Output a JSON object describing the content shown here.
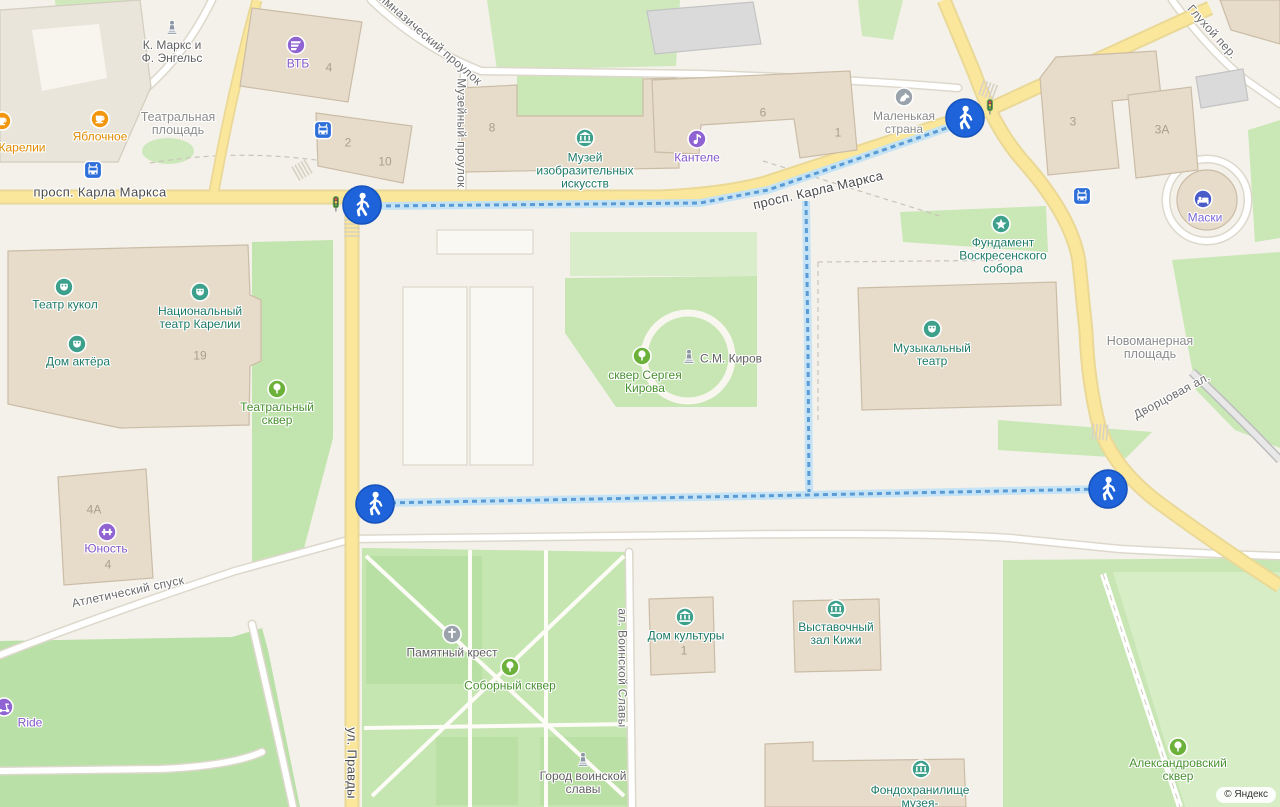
{
  "attribution": "© Яндекс",
  "palette": {
    "marker_blue": "#1e63d9",
    "route_blue": "#5a9bd5",
    "road_yellow": "#fbe79b",
    "park_green": "#c8e6b3",
    "building_tan": "#e7dbca",
    "transport_blue": "#2e6fd9"
  },
  "streets": [
    {
      "id": "prosp-karla-marksa-w",
      "label": "просп. Карла Маркса",
      "x": 100,
      "y": 192,
      "rotate": 0,
      "size": 13,
      "color": "#4c4c4c"
    },
    {
      "id": "prosp-karla-marksa-e",
      "label": "просп. Карла Маркса",
      "x": 818,
      "y": 190,
      "rotate": -13,
      "size": 13,
      "color": "#4c4c4c"
    },
    {
      "id": "ul-pravdy",
      "label": "ул. Правды",
      "x": 352,
      "y": 763,
      "rotate": 90,
      "size": 13,
      "color": "#4c4c4c"
    },
    {
      "id": "gimnazichesky-proulok",
      "label": "Гимназический проулок",
      "x": 428,
      "y": 38,
      "rotate": 41,
      "size": 12,
      "color": "#6b6b6b"
    },
    {
      "id": "muzeyny-proulok",
      "label": "Музейный проулок",
      "x": 461,
      "y": 133,
      "rotate": 90,
      "size": 12,
      "color": "#6b6b6b"
    },
    {
      "id": "glukhoy-per",
      "label": "Глухой пер.",
      "x": 1212,
      "y": 32,
      "rotate": 48,
      "size": 12,
      "color": "#6b6b6b"
    },
    {
      "id": "atletichesky-spusk",
      "label": "Атлетический спуск",
      "x": 128,
      "y": 592,
      "rotate": -12,
      "size": 12,
      "color": "#6b6b6b"
    },
    {
      "id": "al-voinskoy-slavy",
      "label": "ал. Воинской Славы",
      "x": 622,
      "y": 668,
      "rotate": 90,
      "size": 12,
      "color": "#6b6b6b"
    },
    {
      "id": "dvortsovaya-al",
      "label": "Дворцовая ал.",
      "x": 1172,
      "y": 396,
      "rotate": -28,
      "size": 12,
      "color": "#6b6b6b"
    }
  ],
  "areas": [
    {
      "id": "teatralnaya-ploshchad",
      "lines": [
        "Театральная",
        "площадь"
      ],
      "x": 178,
      "y": 124,
      "color": "#8c8c8c"
    },
    {
      "id": "novomanernaya-ploshchad",
      "lines": [
        "Новоманерная",
        "площадь"
      ],
      "x": 1150,
      "y": 348,
      "color": "#8c8c8c"
    }
  ],
  "building_numbers": [
    {
      "label": "4",
      "x": 329,
      "y": 68
    },
    {
      "label": "2",
      "x": 348,
      "y": 143
    },
    {
      "label": "10",
      "x": 385,
      "y": 162
    },
    {
      "label": "8",
      "x": 492,
      "y": 128
    },
    {
      "label": "6",
      "x": 763,
      "y": 113
    },
    {
      "label": "1",
      "x": 838,
      "y": 133
    },
    {
      "label": "3",
      "x": 1073,
      "y": 122
    },
    {
      "label": "3А",
      "x": 1162,
      "y": 130
    },
    {
      "label": "19",
      "x": 200,
      "y": 356
    },
    {
      "label": "4А",
      "x": 94,
      "y": 510
    },
    {
      "label": "4",
      "x": 108,
      "y": 565
    },
    {
      "label": "1",
      "x": 684,
      "y": 651
    }
  ],
  "pois": [
    {
      "id": "karl-marx-engels-monument",
      "icon": "statue",
      "icon_color": "#8d97a3",
      "ix": 172,
      "iy": 27,
      "lines": [
        "К. Маркс и",
        "Ф. Энгельс"
      ],
      "label_color": "#5f5f5f",
      "lx": 172,
      "ly": 52
    },
    {
      "id": "vtb",
      "icon": "bank",
      "icon_color": "#8f63d2",
      "ix": 296,
      "iy": 45,
      "lines": [
        "ВТБ"
      ],
      "label_color": "#8456c9",
      "lx": 298,
      "ly": 64
    },
    {
      "id": "yablochnoe",
      "icon": "coffee",
      "icon_color": "#f2960d",
      "ix": 100,
      "iy": 119,
      "lines": [
        "Яблочное"
      ],
      "label_color": "#e08b00",
      "lx": 100,
      "ly": 137
    },
    {
      "id": "karelii",
      "icon": "coffee",
      "icon_color": "#f2960d",
      "ix": 2,
      "iy": 121,
      "lines": [
        "Карелии"
      ],
      "label_color": "#e08b00",
      "lx": 22,
      "ly": 148
    },
    {
      "id": "muzey-izo",
      "icon": "museum",
      "icon_color": "#3ca08b",
      "ix": 585,
      "iy": 138,
      "lines": [
        "Музей",
        "изобразительных",
        "искусств"
      ],
      "label_color": "#1d7a66",
      "lx": 585,
      "ly": 171
    },
    {
      "id": "kantele",
      "icon": "music",
      "icon_color": "#8f63d2",
      "ix": 697,
      "iy": 139,
      "lines": [
        "Кантеле"
      ],
      "label_color": "#8456c9",
      "lx": 697,
      "ly": 158
    },
    {
      "id": "malenkaya-strana",
      "icon": "horse",
      "icon_color": "#9aa2ac",
      "ix": 904,
      "iy": 97,
      "lines": [
        "Маленькая",
        "страна"
      ],
      "label_color": "#8a8a8a",
      "lx": 904,
      "ly": 123
    },
    {
      "id": "fundament-sobora",
      "icon": "star",
      "icon_color": "#3ca08b",
      "ix": 1001,
      "iy": 224,
      "lines": [
        "Фундамент",
        "Воскресенского",
        "собора"
      ],
      "label_color": "#1d7a66",
      "lx": 1003,
      "ly": 256
    },
    {
      "id": "maski",
      "icon": "bed",
      "icon_color": "#4a5cc9",
      "ix": 1203,
      "iy": 199,
      "lines": [
        "Маски"
      ],
      "label_color": "#7a68d6",
      "lx": 1205,
      "ly": 218
    },
    {
      "id": "teatr-kukol",
      "icon": "mask",
      "icon_color": "#3ca08b",
      "ix": 64,
      "iy": 287,
      "lines": [
        "Театр кукол"
      ],
      "label_color": "#1d7a66",
      "lx": 65,
      "ly": 305
    },
    {
      "id": "natsionalny-teatr-karelii",
      "icon": "mask",
      "icon_color": "#3ca08b",
      "ix": 200,
      "iy": 292,
      "lines": [
        "Национальный",
        "театр Карелии"
      ],
      "label_color": "#1d7a66",
      "lx": 200,
      "ly": 318
    },
    {
      "id": "dom-aktyora",
      "icon": "mask",
      "icon_color": "#3ca08b",
      "ix": 77,
      "iy": 344,
      "lines": [
        "Дом актёра"
      ],
      "label_color": "#1d7a66",
      "lx": 78,
      "ly": 362
    },
    {
      "id": "teatralny-skver",
      "icon": "tree",
      "icon_color": "#6cb13a",
      "ix": 277,
      "iy": 389,
      "lines": [
        "Театральный",
        "сквер"
      ],
      "label_color": "#47902f",
      "lx": 277,
      "ly": 414
    },
    {
      "id": "skver-sergeya-kirova",
      "icon": "tree",
      "icon_color": "#6cb13a",
      "ix": 642,
      "iy": 356,
      "lines": [
        "сквер Сергея",
        "Кирова"
      ],
      "label_color": "#47902f",
      "lx": 645,
      "ly": 382
    },
    {
      "id": "kirov-monument",
      "icon": "statue",
      "icon_color": "#8d97a3",
      "ix": 689,
      "iy": 356,
      "lines": [
        "С.М. Киров"
      ],
      "label_color": "#5f5f5f",
      "lx": 731,
      "ly": 359
    },
    {
      "id": "muzykalny-teatr",
      "icon": "mask",
      "icon_color": "#3ca08b",
      "ix": 932,
      "iy": 329,
      "lines": [
        "Музыкальный",
        "театр"
      ],
      "label_color": "#1d7a66",
      "lx": 932,
      "ly": 355
    },
    {
      "id": "yunost",
      "icon": "dumbbell",
      "icon_color": "#8f63d2",
      "ix": 107,
      "iy": 532,
      "lines": [
        "Юность"
      ],
      "label_color": "#8456c9",
      "lx": 106,
      "ly": 549
    },
    {
      "id": "pamyatny-krest",
      "icon": "cross",
      "icon_color": "#9aa2ac",
      "ix": 452,
      "iy": 634,
      "lines": [
        "Памятный крест"
      ],
      "label_color": "#5f5f5f",
      "lx": 452,
      "ly": 653
    },
    {
      "id": "soborny-skver",
      "icon": "tree",
      "icon_color": "#6cb13a",
      "ix": 510,
      "iy": 667,
      "lines": [
        "Соборный сквер"
      ],
      "label_color": "#47902f",
      "lx": 510,
      "ly": 686
    },
    {
      "id": "dom-kultury",
      "icon": "museum",
      "icon_color": "#3ca08b",
      "ix": 685,
      "iy": 617,
      "lines": [
        "Дом культуры"
      ],
      "label_color": "#1d7a66",
      "lx": 686,
      "ly": 636
    },
    {
      "id": "vystavochny-zal-kizhi",
      "icon": "museum",
      "icon_color": "#3ca08b",
      "ix": 836,
      "iy": 609,
      "lines": [
        "Выставочный",
        "зал Кижи"
      ],
      "label_color": "#1d7a66",
      "lx": 836,
      "ly": 634
    },
    {
      "id": "gorod-voinskoy-slavy",
      "icon": "statue",
      "icon_color": "#8d97a3",
      "ix": 583,
      "iy": 759,
      "lines": [
        "Город воинской",
        "славы"
      ],
      "label_color": "#5f5f5f",
      "lx": 583,
      "ly": 783
    },
    {
      "id": "fondokhranilishche-muzeya",
      "icon": "museum",
      "icon_color": "#3ca08b",
      "ix": 921,
      "iy": 769,
      "lines": [
        "Фондохранилище",
        "музея-"
      ],
      "label_color": "#1d7a66",
      "lx": 920,
      "ly": 797
    },
    {
      "id": "aleksandrovsky-skver",
      "icon": "tree",
      "icon_color": "#6cb13a",
      "ix": 1178,
      "iy": 747,
      "lines": [
        "Александровский",
        "сквер"
      ],
      "label_color": "#47902f",
      "lx": 1178,
      "ly": 770
    },
    {
      "id": "ride",
      "icon": "scooter",
      "icon_color": "#8f63d2",
      "ix": 4,
      "iy": 707,
      "lines": [
        "Ride"
      ],
      "label_color": "#8456c9",
      "lx": 30,
      "ly": 723
    }
  ],
  "transport_stops": [
    {
      "x": 93,
      "y": 170
    },
    {
      "x": 323,
      "y": 130
    },
    {
      "x": 1082,
      "y": 196
    }
  ],
  "traffic_lights": [
    {
      "x": 336,
      "y": 204
    },
    {
      "x": 990,
      "y": 107
    }
  ],
  "route_markers": [
    {
      "x": 362,
      "y": 205
    },
    {
      "x": 965,
      "y": 118
    },
    {
      "x": 375,
      "y": 504
    },
    {
      "x": 1108,
      "y": 489
    }
  ]
}
